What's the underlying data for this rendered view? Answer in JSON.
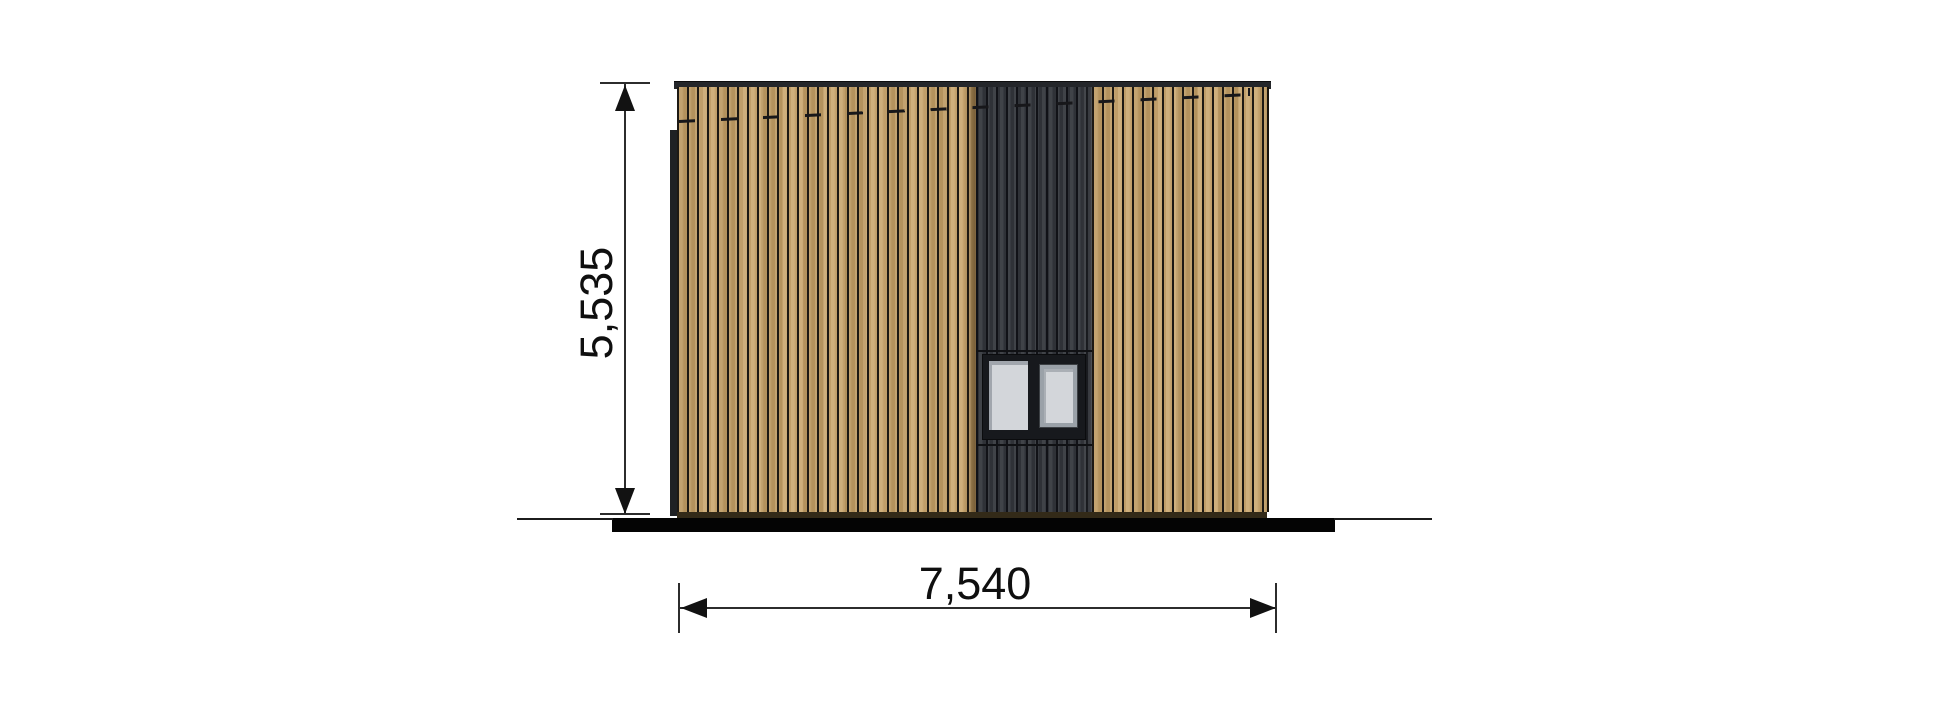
{
  "drawing": {
    "dimensions": {
      "height_label": "5,535",
      "width_label": "7,540"
    },
    "colors": {
      "bg": "#ffffff",
      "wood": "#c7a267",
      "wood-line": "#1d1914",
      "dark": "#34373d",
      "dark-line": "#111217",
      "cap": "#24262a",
      "frame": "#17191d",
      "glass": "#d3d6da",
      "sash": "#9aa1a8",
      "ground": "#040404",
      "dim": "#2c2c2c"
    }
  }
}
